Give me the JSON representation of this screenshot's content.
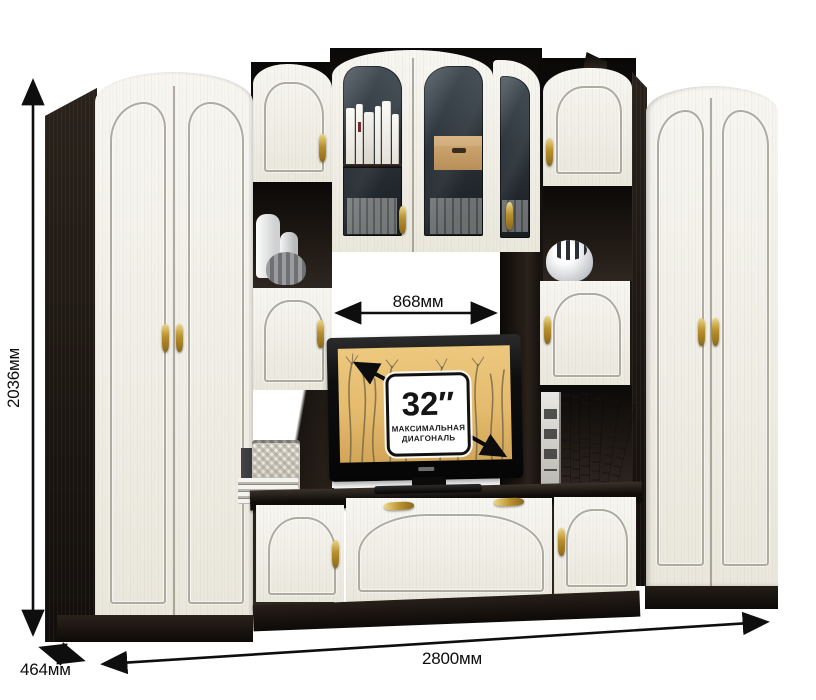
{
  "annotations": {
    "height": "2036мм",
    "depth": "464мм",
    "width": "2800мм",
    "tv_niche_width": "868мм"
  },
  "tv_badge": {
    "diagonal": "32″",
    "caption_line1": "МАКСИМАЛЬНАЯ",
    "caption_line2": "ДИАГОНАЛЬ"
  },
  "colors": {
    "background": "#ffffff",
    "cream": "#efede4",
    "cream_light": "#f7f6f1",
    "outline_silver": "#aeaba0",
    "wenge": "#221c18",
    "wenge_deep": "#120e0b",
    "gold": "#c7a53e",
    "screen_amber": "#e5bb6e",
    "annotation": "#0e0e0e"
  }
}
